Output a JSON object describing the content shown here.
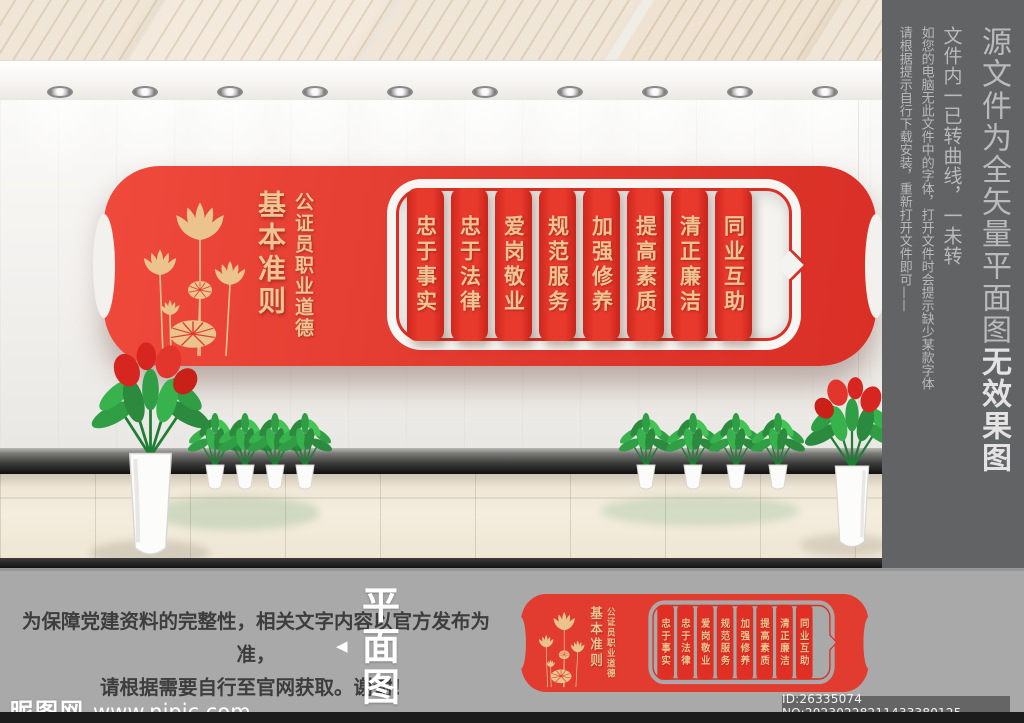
{
  "sidebar": {
    "title_main": "源文件为全矢量平面图",
    "title_bold": "无效果图",
    "note1": "文件内一已转曲线，一未转",
    "note2": "如您的电脑无此文件中的字体，打开文件时会提示缺少某款字体",
    "note3": "请根据提示自行下载安装，重新打开文件即可——"
  },
  "banner": {
    "title_main": "基本准则",
    "title_sub": "公证员职业道德",
    "strips": [
      "忠于事实",
      "忠于法律",
      "爱岗敬业",
      "规范服务",
      "加强修养",
      "提高素质",
      "清正廉洁",
      "同业互助"
    ]
  },
  "footer": {
    "disclaimer_line1": "为保障党建资料的完整性，相关文字内容以官方发布为准，",
    "disclaimer_line2": "请根据需要自行至官网获取。谢谢！",
    "flat_view_arrow": "◀",
    "flat_view_label": "平面图",
    "watermark_site": "昵图网",
    "watermark_url": "www.nipic.com",
    "id_text": "ID:26335074 NO:20230228211433380125"
  },
  "colors": {
    "banner_red": "#e23b30",
    "text_gold": "#eec592",
    "sidebar_gray": "#626365",
    "footer_gray": "#a9a9a9",
    "floor_beige": "#efe6d4"
  }
}
